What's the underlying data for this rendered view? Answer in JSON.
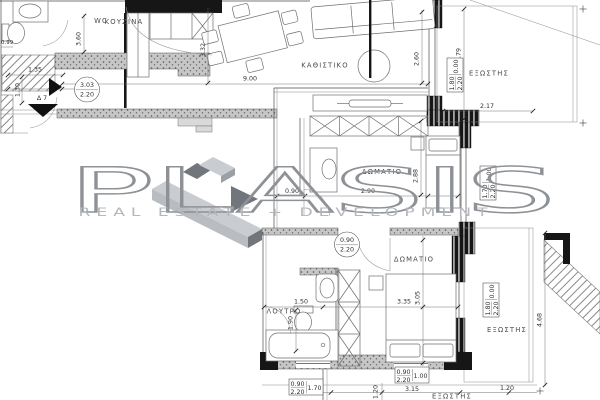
{
  "watermark": {
    "brand": "PLASIS",
    "tagline": "REAL ESTATE + DEVELOPMENT"
  },
  "rooms": {
    "wc": "WC",
    "kitchen": "ΚΟΥΖΙΝΑ",
    "living_room": "ΚΑΘΙΣΤΙΚΟ",
    "bedroom_1": "ΔΩΜΑΤΙΟ",
    "bedroom_2": "ΔΩΜΑΤΙΟ",
    "bathroom": "ΛΟΥΤΡΟ",
    "balcony_top": "ΕΞΩΣΤΗΣ",
    "balcony_right": "ΕΞΩΣΤΗΣ",
    "balcony_bottom": "ΕΞΩΣΤΗΣ"
  },
  "dimensions": {
    "wc_side": "3.60",
    "entry_w": "1.35",
    "entry_d": "1.30",
    "edge_small": "0.99",
    "dining_d": "3.32",
    "living_w": "9.00",
    "living_d": "2.60",
    "balc_top_d": "3.79",
    "balc_top_w": "2.17",
    "bed1_d": "2.88",
    "hall_w": "0.90",
    "bed1_w": "2.90",
    "bath_w": "1.50",
    "bath_d": "1.90",
    "bed2_w": "3.35",
    "bed2_d": "3.05",
    "balc_right_d": "4.68",
    "balc_right_w": "1.20",
    "south_w": "3.15",
    "south_off": "1.20"
  },
  "door_tags": {
    "entry": {
      "top": "3.03",
      "bottom": "2.20"
    },
    "bedroom2": {
      "top": "0.90",
      "bottom": "2.20"
    }
  },
  "window_tags": {
    "living_east": {
      "size": "1.80",
      "height": "2.20",
      "sill": "0.00"
    },
    "bedroom1_east": {
      "size": "1.70",
      "height": "2.20",
      "sill": "1.00"
    },
    "bedroom2_east": {
      "size": "1.80",
      "height": "2.20",
      "sill": "0.00"
    },
    "bathroom_south": {
      "size": "0.90",
      "height": "2.20",
      "sill": "1.70"
    },
    "bedroom2_south": {
      "size": "0.90",
      "height": "2.20",
      "sill": "1.00"
    }
  },
  "annotations": {
    "level_marker": "Δ 7"
  },
  "colors": {
    "wall_dark": "#161616",
    "wall_gray": "#c6c6c6",
    "line": "#4a4a4a",
    "logo_stroke": "#8e9296",
    "logo_light": "#c9ccd0",
    "logo_mid": "#b9bdc1",
    "logo_dark": "#70767c",
    "logo_tagline": "#b4b8bc"
  }
}
